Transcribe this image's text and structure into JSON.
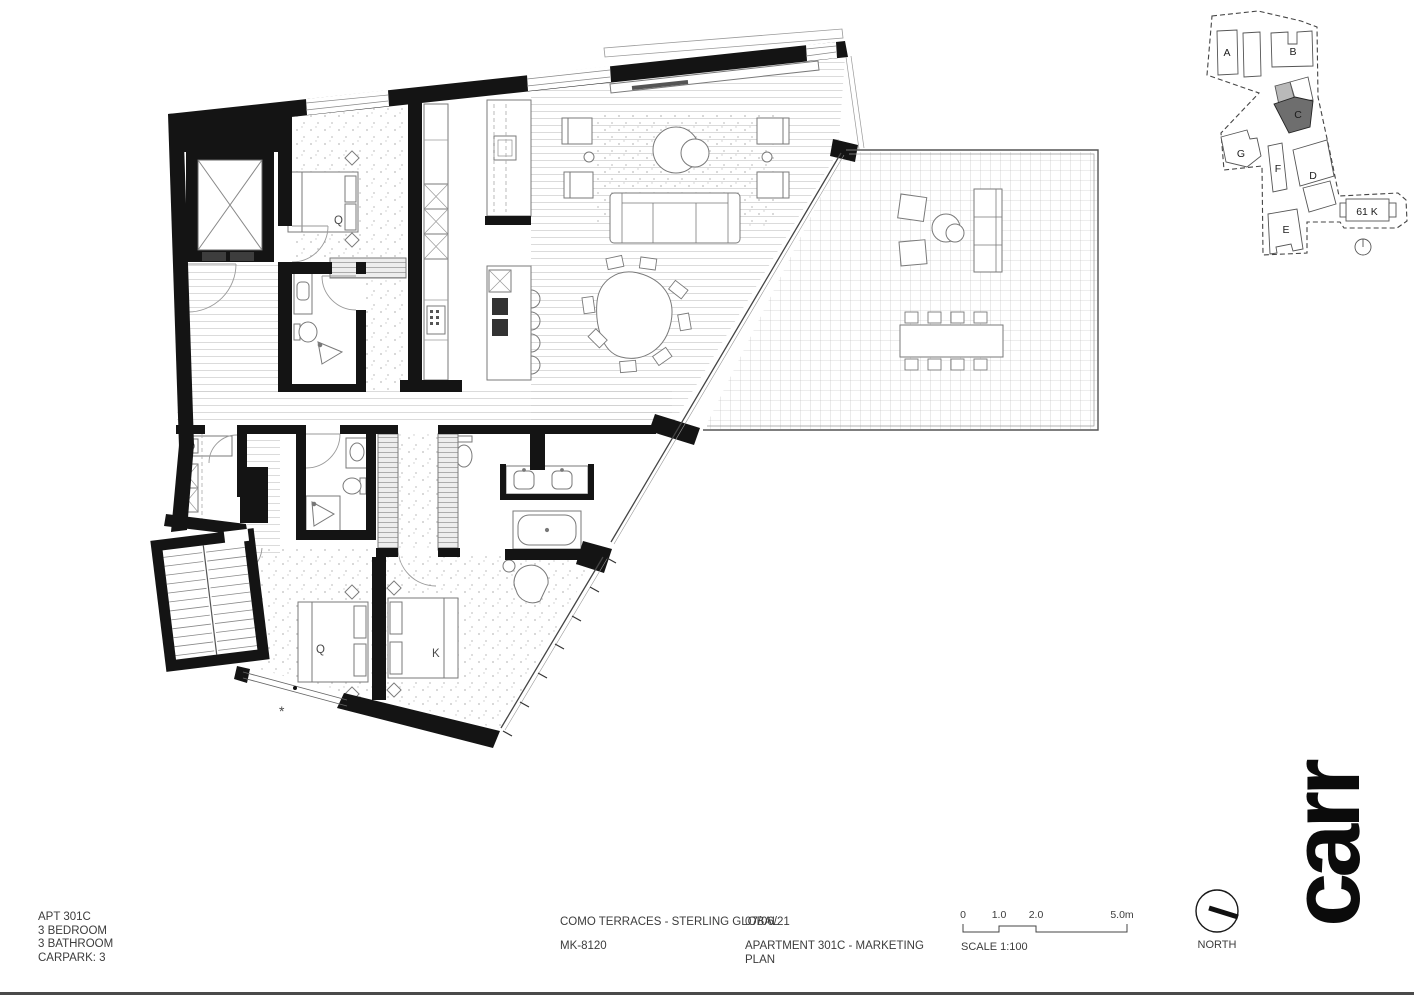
{
  "plan": {
    "bedroom2_label": "Q",
    "bedroom3_label": "Q",
    "master_label": "K",
    "window_marker": "*"
  },
  "keyplan": {
    "building_a": "A",
    "building_b": "B",
    "building_c": "C",
    "building_d": "D",
    "building_e": "E",
    "building_f": "F",
    "building_g": "G",
    "lot_label": "61 K",
    "highlight_fill": "#6e6e6e",
    "secondary_fill": "#b9b9b9"
  },
  "titleblock": {
    "apt_lines": [
      "APT 301C",
      "3 BEDROOM",
      "3 BATHROOM",
      "CARPARK: 3"
    ],
    "project": "COMO TERRACES - STERLING GLOBAL",
    "drawing_number": "MK-8120",
    "date": "07/06/21",
    "drawing_title_line1": "APARTMENT 301C - MARKETING",
    "drawing_title_line2": "PLAN",
    "scale_ticks": [
      "0",
      "1.0",
      "2.0",
      "5.0m"
    ],
    "scale_label": "SCALE 1:100",
    "north_label": "NORTH"
  },
  "logo": {
    "text": "carr"
  }
}
